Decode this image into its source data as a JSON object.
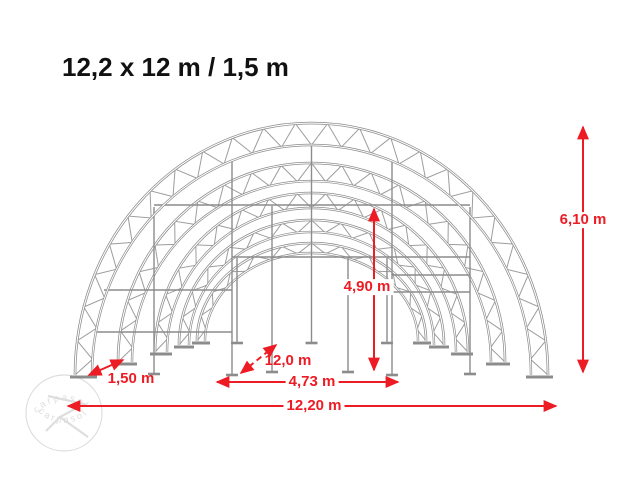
{
  "title": "12,2 x 12 m / 1,5 m",
  "watermark": {
    "text": "carpasol"
  },
  "diagram": {
    "colors": {
      "dimension_red": "#ed1c24",
      "structure_gray": "#8c8c8c",
      "watermark_gray": "#dedede"
    },
    "dimensions": {
      "total_height": "6,10 m",
      "clear_height": "4,90 m",
      "depth": "12,0 m",
      "door_width": "4,73 m",
      "arch_spacing": "1,50 m",
      "total_width": "12,20 m"
    }
  }
}
